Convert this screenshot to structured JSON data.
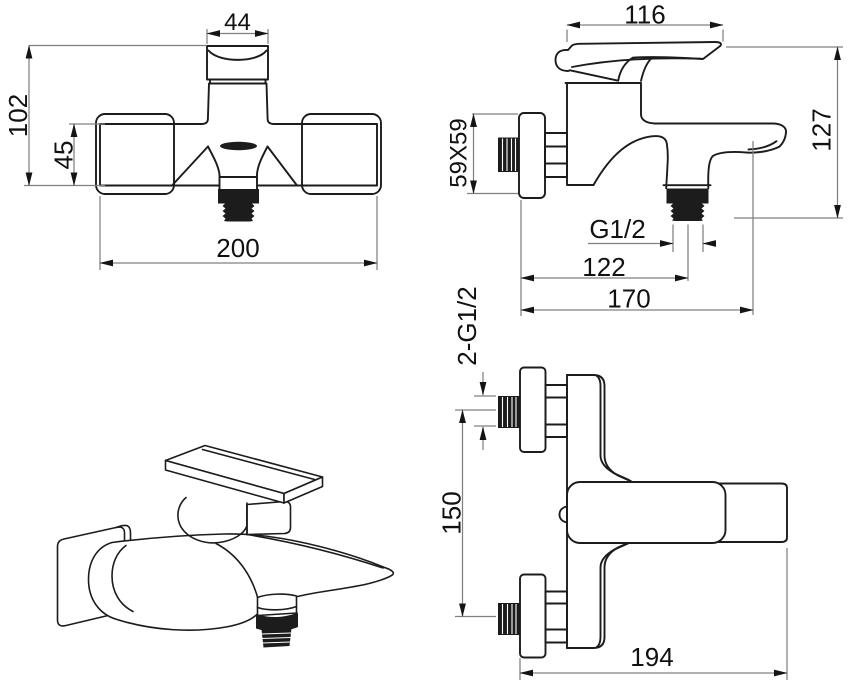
{
  "colors": {
    "background": "#ffffff",
    "object_line": "#1c1c1c",
    "dimension_line": "#808080",
    "label_text": "#111111"
  },
  "views": {
    "front_view": {
      "labels": {
        "spout_width": "44",
        "overall_height": "102",
        "body_height": "45",
        "body_width": "200"
      }
    },
    "side_view": {
      "labels": {
        "handle_length": "116",
        "escutcheon_size": "59X59",
        "overall_height": "127",
        "outlet_thread": "G1/2",
        "outlet_offset": "122",
        "overall_depth": "170"
      }
    },
    "top_view": {
      "labels": {
        "inlet_thread": "2-G1/2",
        "inlet_spacing": "150",
        "overall_width": "194"
      }
    }
  }
}
